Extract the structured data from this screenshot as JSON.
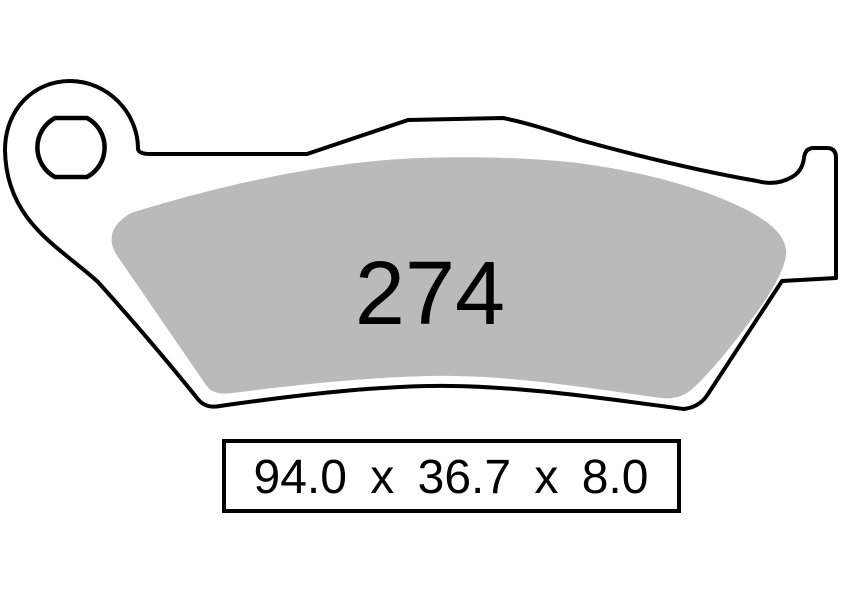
{
  "diagram": {
    "part_number": "274",
    "dimensions": {
      "display": "94.0 x 36.7 x 8.0",
      "length": "94.0",
      "width": "36.7",
      "thickness": "8.0",
      "separator": "x"
    },
    "colors": {
      "outline": "#000000",
      "friction_material": "#bababa",
      "background": "#ffffff",
      "text": "#000000"
    }
  }
}
